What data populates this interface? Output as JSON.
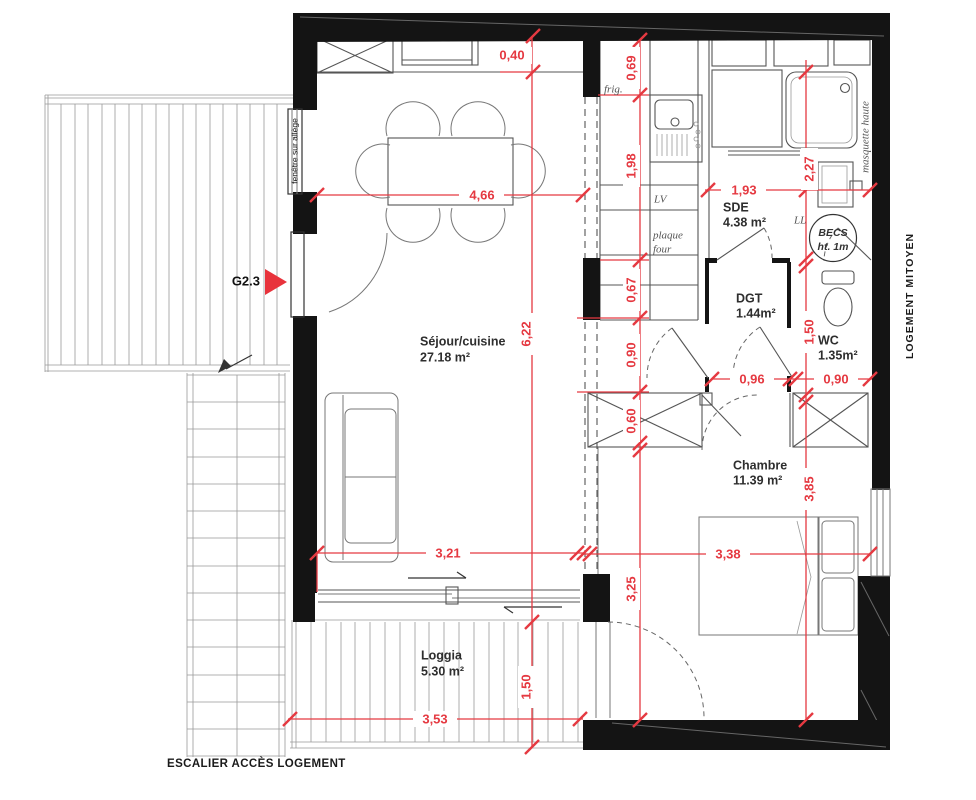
{
  "title": "apartment-floor-plan",
  "colors": {
    "dim": "#e53941",
    "wall": "#141414",
    "line": "#555555"
  },
  "rooms": [
    {
      "name": "Séjour/cuisine",
      "area": "27.18 m²"
    },
    {
      "name": "SDE",
      "area": "4.38 m²"
    },
    {
      "name": "DGT",
      "area": "1.44m²"
    },
    {
      "name": "WC",
      "area": "1.35m²"
    },
    {
      "name": "Chambre",
      "area": "11.39 m²"
    },
    {
      "name": "Loggia",
      "area": "5.30 m²"
    }
  ],
  "dims": [
    {
      "v": "0,40"
    },
    {
      "v": "0,69"
    },
    {
      "v": "1,98"
    },
    {
      "v": "4,66"
    },
    {
      "v": "1,93"
    },
    {
      "v": "2,27"
    },
    {
      "v": "6,22"
    },
    {
      "v": "0,67"
    },
    {
      "v": "0,90"
    },
    {
      "v": "1,50"
    },
    {
      "v": "0,96"
    },
    {
      "v": "0,90"
    },
    {
      "v": "0,60"
    },
    {
      "v": "3,85"
    },
    {
      "v": "3,25"
    },
    {
      "v": "3,21"
    },
    {
      "v": "3,38"
    },
    {
      "v": "1,50"
    },
    {
      "v": "3,53"
    }
  ],
  "labels": {
    "window_sill": "fenêtre sur allège",
    "entry_ref": "G2.3",
    "stairs": "ESCALIER ACCÈS LOGEMENT",
    "adjacent_unit": "LOGEMENT MITOYEN",
    "partition": "masquette haute",
    "fridge": "frig.",
    "dishwasher": "LV",
    "hob_line1": "plaque",
    "hob_line2": "four",
    "washer": "LL",
    "water_heater": "BECS",
    "water_heater_h": "ht. 1m"
  }
}
